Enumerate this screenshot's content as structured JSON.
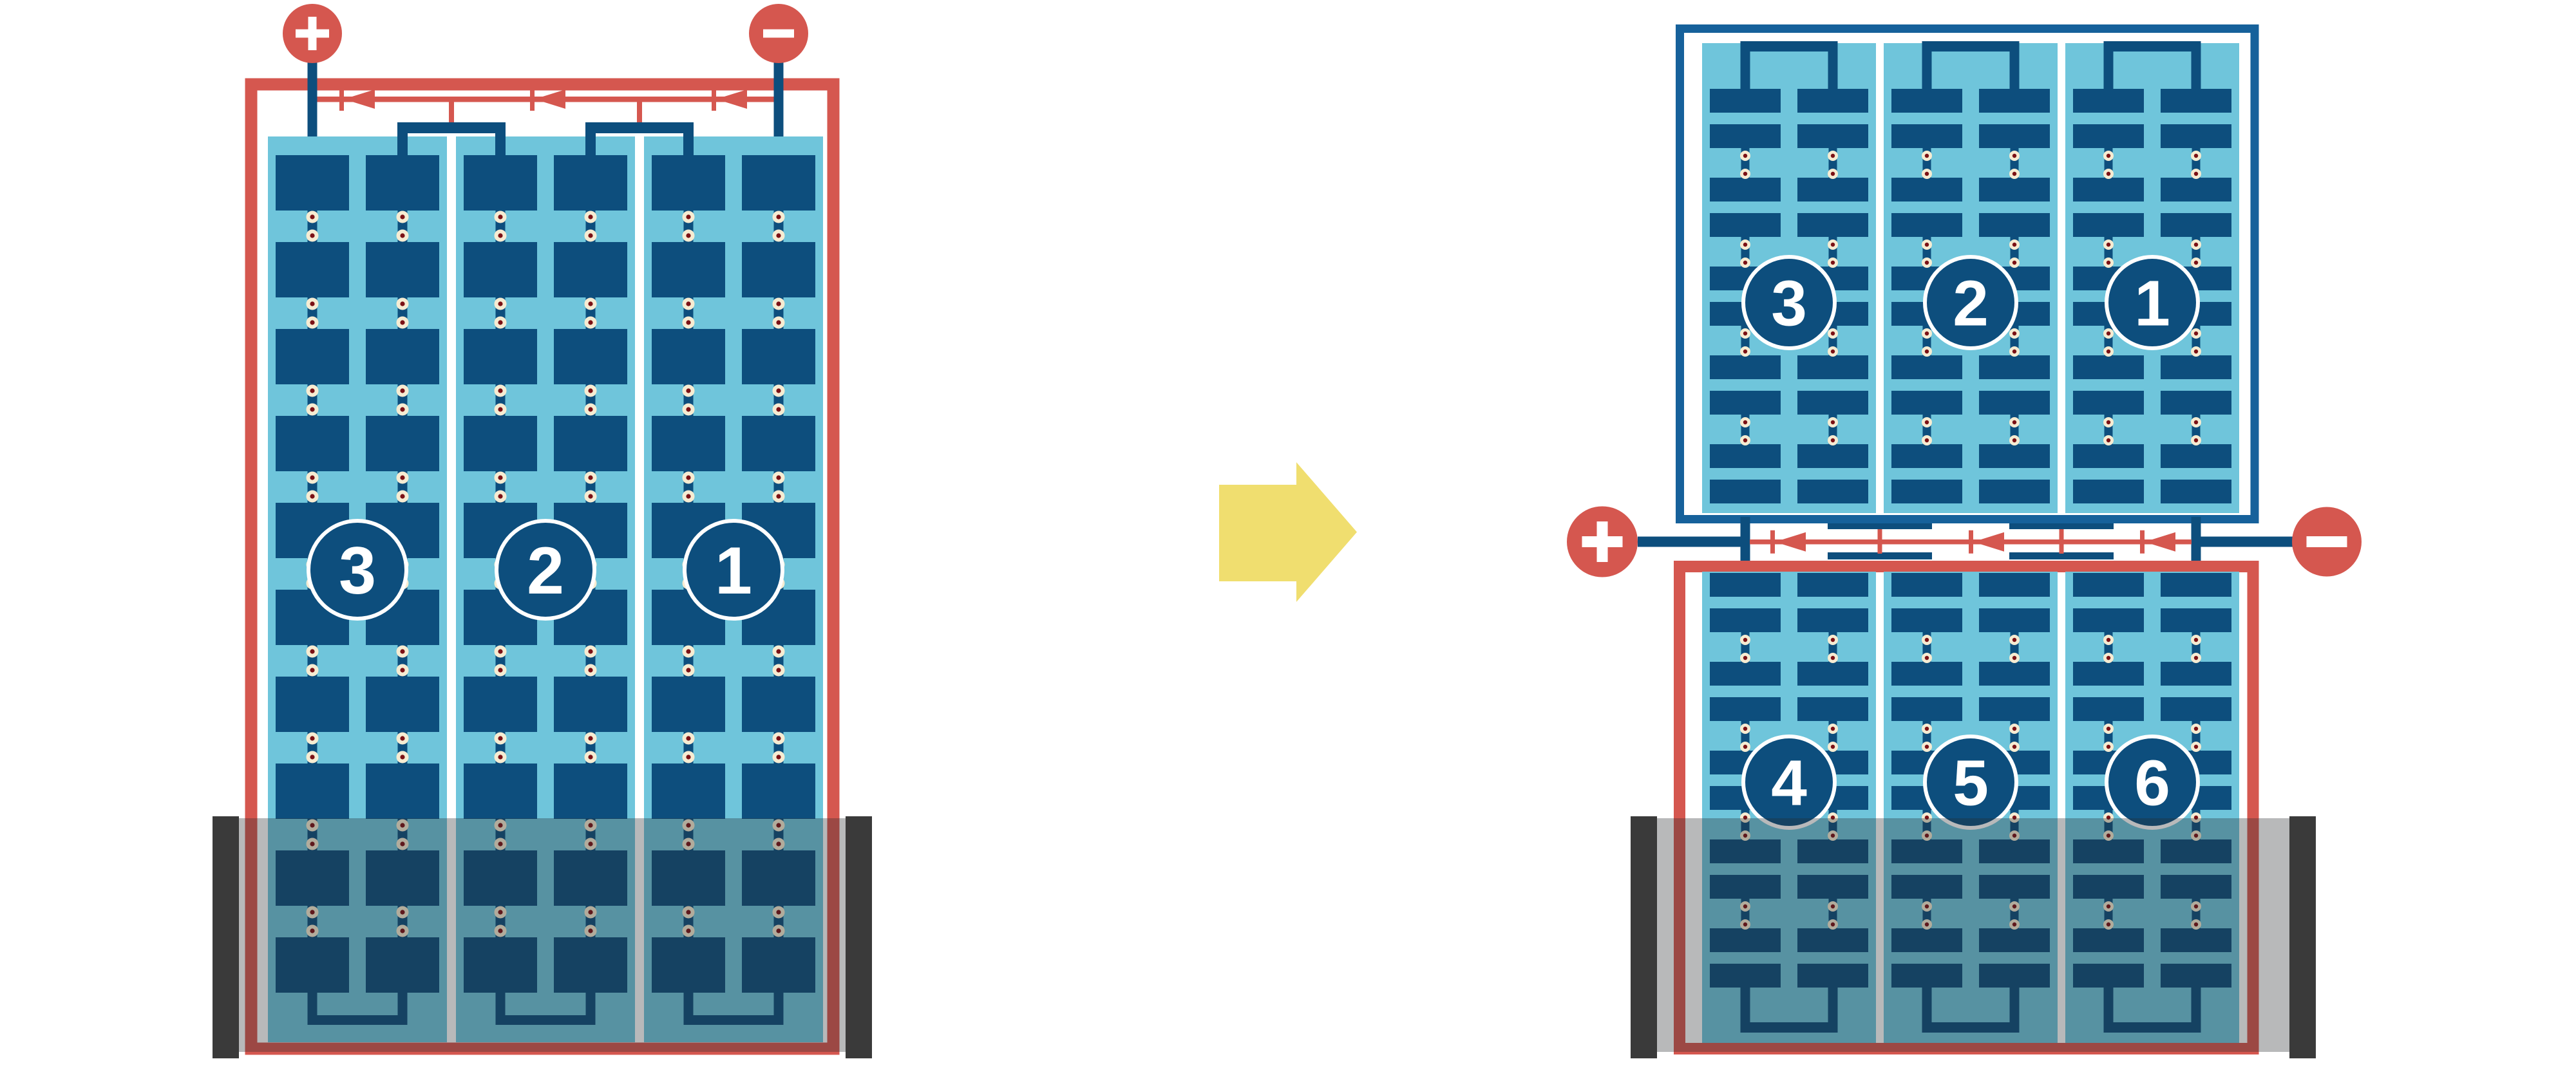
{
  "diagram": {
    "description_kind": "battery-module-reconfiguration",
    "left_module": {
      "terminal_positive_label": "+",
      "terminal_negative_label": "-",
      "cell_labels": [
        "3",
        "2",
        "1"
      ]
    },
    "transition_arrow_direction": "right",
    "right_assembly": {
      "terminal_positive_label": "+",
      "terminal_negative_label": "-",
      "top_module_cell_labels": [
        "3",
        "2",
        "1"
      ],
      "bottom_module_cell_labels": [
        "4",
        "5",
        "6"
      ]
    },
    "colors": {
      "cell_dark_blue": "#0d4e7d",
      "panel_light_blue": "#6fc5db",
      "wire_red": "#d5574f",
      "frame_blue": "#16619b",
      "solder_cream": "#f6ecd2",
      "solder_core": "#7b1115",
      "arrow_yellow": "#f0de6f",
      "holder_dark": "#3a3a3a",
      "holder_shade": "rgba(40,42,45,0.33)",
      "background": "#ffffff",
      "badge_ring": "#ffffff"
    }
  }
}
